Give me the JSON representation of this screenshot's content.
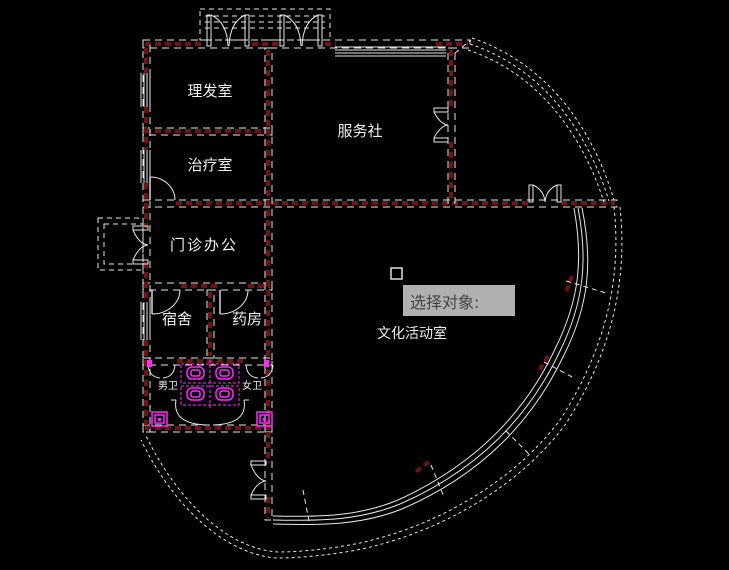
{
  "window": {
    "width": 729,
    "height": 570,
    "background": "#000000"
  },
  "app": {
    "kind": "cad-floor-plan-view"
  },
  "colors": {
    "line": "#e8e8e8",
    "wall": "#6e1414",
    "fixture": "#ff2bff",
    "label": "#f0f0f0",
    "tooltip_bg": "#b0b0b0",
    "tooltip_text": "#454545"
  },
  "plan": {
    "rooms": [
      {
        "id": "barber-room",
        "label": "理发室"
      },
      {
        "id": "service-agency",
        "label": "服务社"
      },
      {
        "id": "treatment-room",
        "label": "治疗室"
      },
      {
        "id": "clinic-office",
        "label": "门诊办公"
      },
      {
        "id": "dormitory",
        "label": "宿舍"
      },
      {
        "id": "pharmacy",
        "label": "药房"
      },
      {
        "id": "culture-activity-room",
        "label": "文化活动室"
      },
      {
        "id": "mens-wc",
        "label": "男卫"
      },
      {
        "id": "womens-wc",
        "label": "女卫"
      }
    ],
    "fixtures": [
      {
        "id": "squat-toilets",
        "count": 4
      },
      {
        "id": "floor-drains",
        "count": 2
      },
      {
        "id": "wash-basins",
        "count": 2
      }
    ]
  },
  "command_prompt": {
    "text": "选择对象:"
  }
}
